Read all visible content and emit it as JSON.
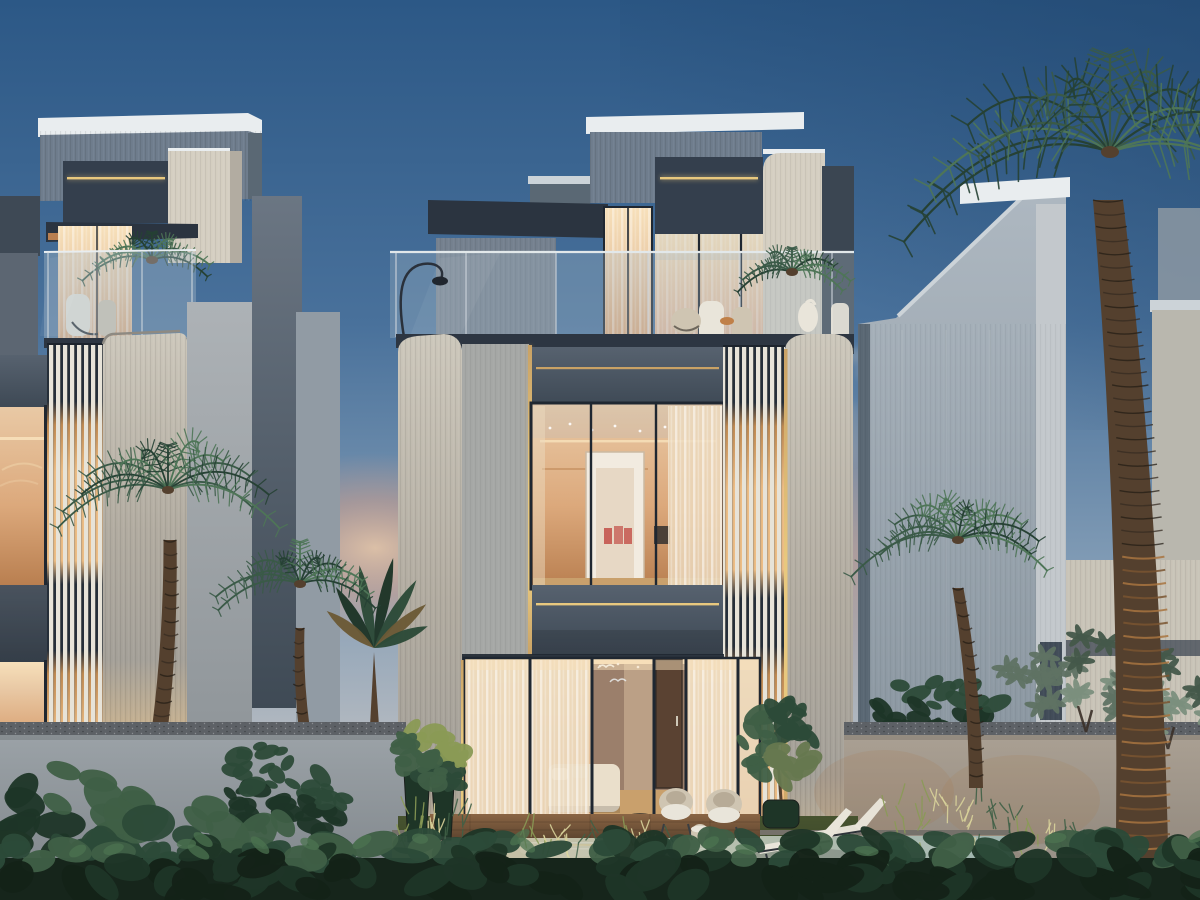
{
  "scene": {
    "type": "architectural-dusk-render",
    "description": "Three modern multi-storey villas at dusk with warm-lit glass interiors, gold accent light lines, vertical louver screens, roof terraces with glass railings, palm trees, frangipani and banana plants, garden walls with uplights, a plunge pool, sun loungers and a leafy foreground hedge under a deep blue evening sky with a pink sunset glow and a wisp of smoke.",
    "elements": [
      "evening-sky",
      "sunset-glow",
      "smoke-wisp",
      "left-villa",
      "center-villa",
      "right-villa",
      "background-building",
      "roof-terrace",
      "glass-railing",
      "arc-floor-lamp",
      "louver-screen",
      "gold-light-line",
      "lit-window",
      "sheer-curtains",
      "living-room",
      "wood-door",
      "bird-decals",
      "patio-armchair",
      "drum-side-table",
      "olive-tree",
      "planter-pot",
      "sun-lounger",
      "plunge-pool",
      "timber-deck",
      "garden-wall",
      "garden-uplight",
      "gravel-path",
      "palm-tree",
      "banana-plant",
      "frangipani-tree",
      "foreground-hedge"
    ]
  },
  "palette": {
    "sky_top": "#2c5886",
    "sky_mid": "#49719b",
    "sky_low": "#7f9ab4",
    "sky_horizon": "#aeb6bf",
    "sunset_bright": "#f2c9a4",
    "sunset_pink": "#e2a183",
    "corner_dark": "#1d4066",
    "smoke": "#9aa3ad",
    "roof_white": "#e9edef",
    "roof_shade": "#ccd3d8",
    "panel_grey": "#6f7d8d",
    "panel_grey_dark": "#5a6874",
    "charcoal": "#343f4d",
    "canopy": "#2b3440",
    "band_top": "#57626f",
    "band_bottom": "#3e4955",
    "parapet": "#2d3642",
    "frame_dark": "#1f2731",
    "gold": "#e8c87e",
    "gold_dim": "#c9a265",
    "cream": "#d5cfc2",
    "cream_shade": "#b2aca1",
    "fin_top": "#cdc8bc",
    "fin_bottom": "#a5a199",
    "fin_warm": "#c9b391",
    "panelB": "#a6a8a6",
    "slab_grey": "#5c6672",
    "dfin_top": "#6b7683",
    "dfin_bottom": "#3f4a55",
    "gap_panel": "#919ba4",
    "flat_top": "#adb2b6",
    "flat_bottom": "#8f9599",
    "under_wall": "#75818f",
    "redge": "#3b4652",
    "louver_white": "#e7e3d8",
    "glow_dark_gap": "#262f3a",
    "glow_deep": "#c08a52",
    "glow_warm": "#edbd85",
    "room_bright": "#f7e0ba",
    "room_top": "#e9c9a5",
    "room_mid": "#dca97c",
    "room_deep": "#b97f50",
    "curtain": "#ecd9bd",
    "curtain_pink": "#ddb093",
    "glass_blue": "#a9bac8",
    "door_white": "#f2ebe0",
    "door_trim": "#cbb9a2",
    "door_inner": "#e7d8c5",
    "art_red": "#c4574e",
    "sconce": "#4a4038",
    "shelf_warm": "#b9804e",
    "floor_wood": "#c9a06c",
    "back_wall": "#9b7f6b",
    "sofa": "#eadfcb",
    "wood_door": "#5a4232",
    "right_face_top": "#aeb8c1",
    "right_face_bottom": "#8c98a2",
    "right_light_col": "#c3c8cc",
    "bg_building": "#b9b7ae",
    "bg_lower": "#c9c4b8",
    "wall_cap": "#5d6166",
    "wall_cool_top": "#9ba2a7",
    "wall_cool_bottom": "#7d8388",
    "wall_warm_top": "#aaa093",
    "wall_warm_bottom": "#8a8177",
    "coping": "#75716a",
    "gravel": "#b3a898",
    "pool_warm": "#cdc0a0",
    "pool_mid": "#b9c0ae",
    "pool_cool": "#9eb4ae",
    "deck": "#8a6544",
    "deck_dark": "#5f4630",
    "grass": "#47532f",
    "grass_dark": "#2e3a22",
    "grass_lit": "#8a9a55",
    "uplight": "#d8d29a",
    "leaf_dark": "#1e3527",
    "leaf_mid": "#2c4a38",
    "leaf_light": "#3f5f46",
    "leaf_bright": "#4c7350",
    "palm_dark": "#264134",
    "palm_green": "#3a5a47",
    "palm_light": "#4e7557",
    "plumeria_light": "#7b8f7d",
    "plumeria_mid": "#5f7263",
    "plumeria_dark": "#44584a",
    "trunk_dark": "#352b21",
    "trunk_mid": "#54402e",
    "trunk_warm": "#7a5530",
    "trunk_lit": "#a87440",
    "trunk_low": "#6e4c2c",
    "hedge_base": "#16251b",
    "hedge_front": "#142218",
    "olive": "#66784f",
    "banana_warm": "#6b5a36",
    "furniture_white": "#e9e5da",
    "furniture_tan": "#cfc5b2",
    "cushion": "#b7ab97",
    "table_warm": "#c08048"
  }
}
